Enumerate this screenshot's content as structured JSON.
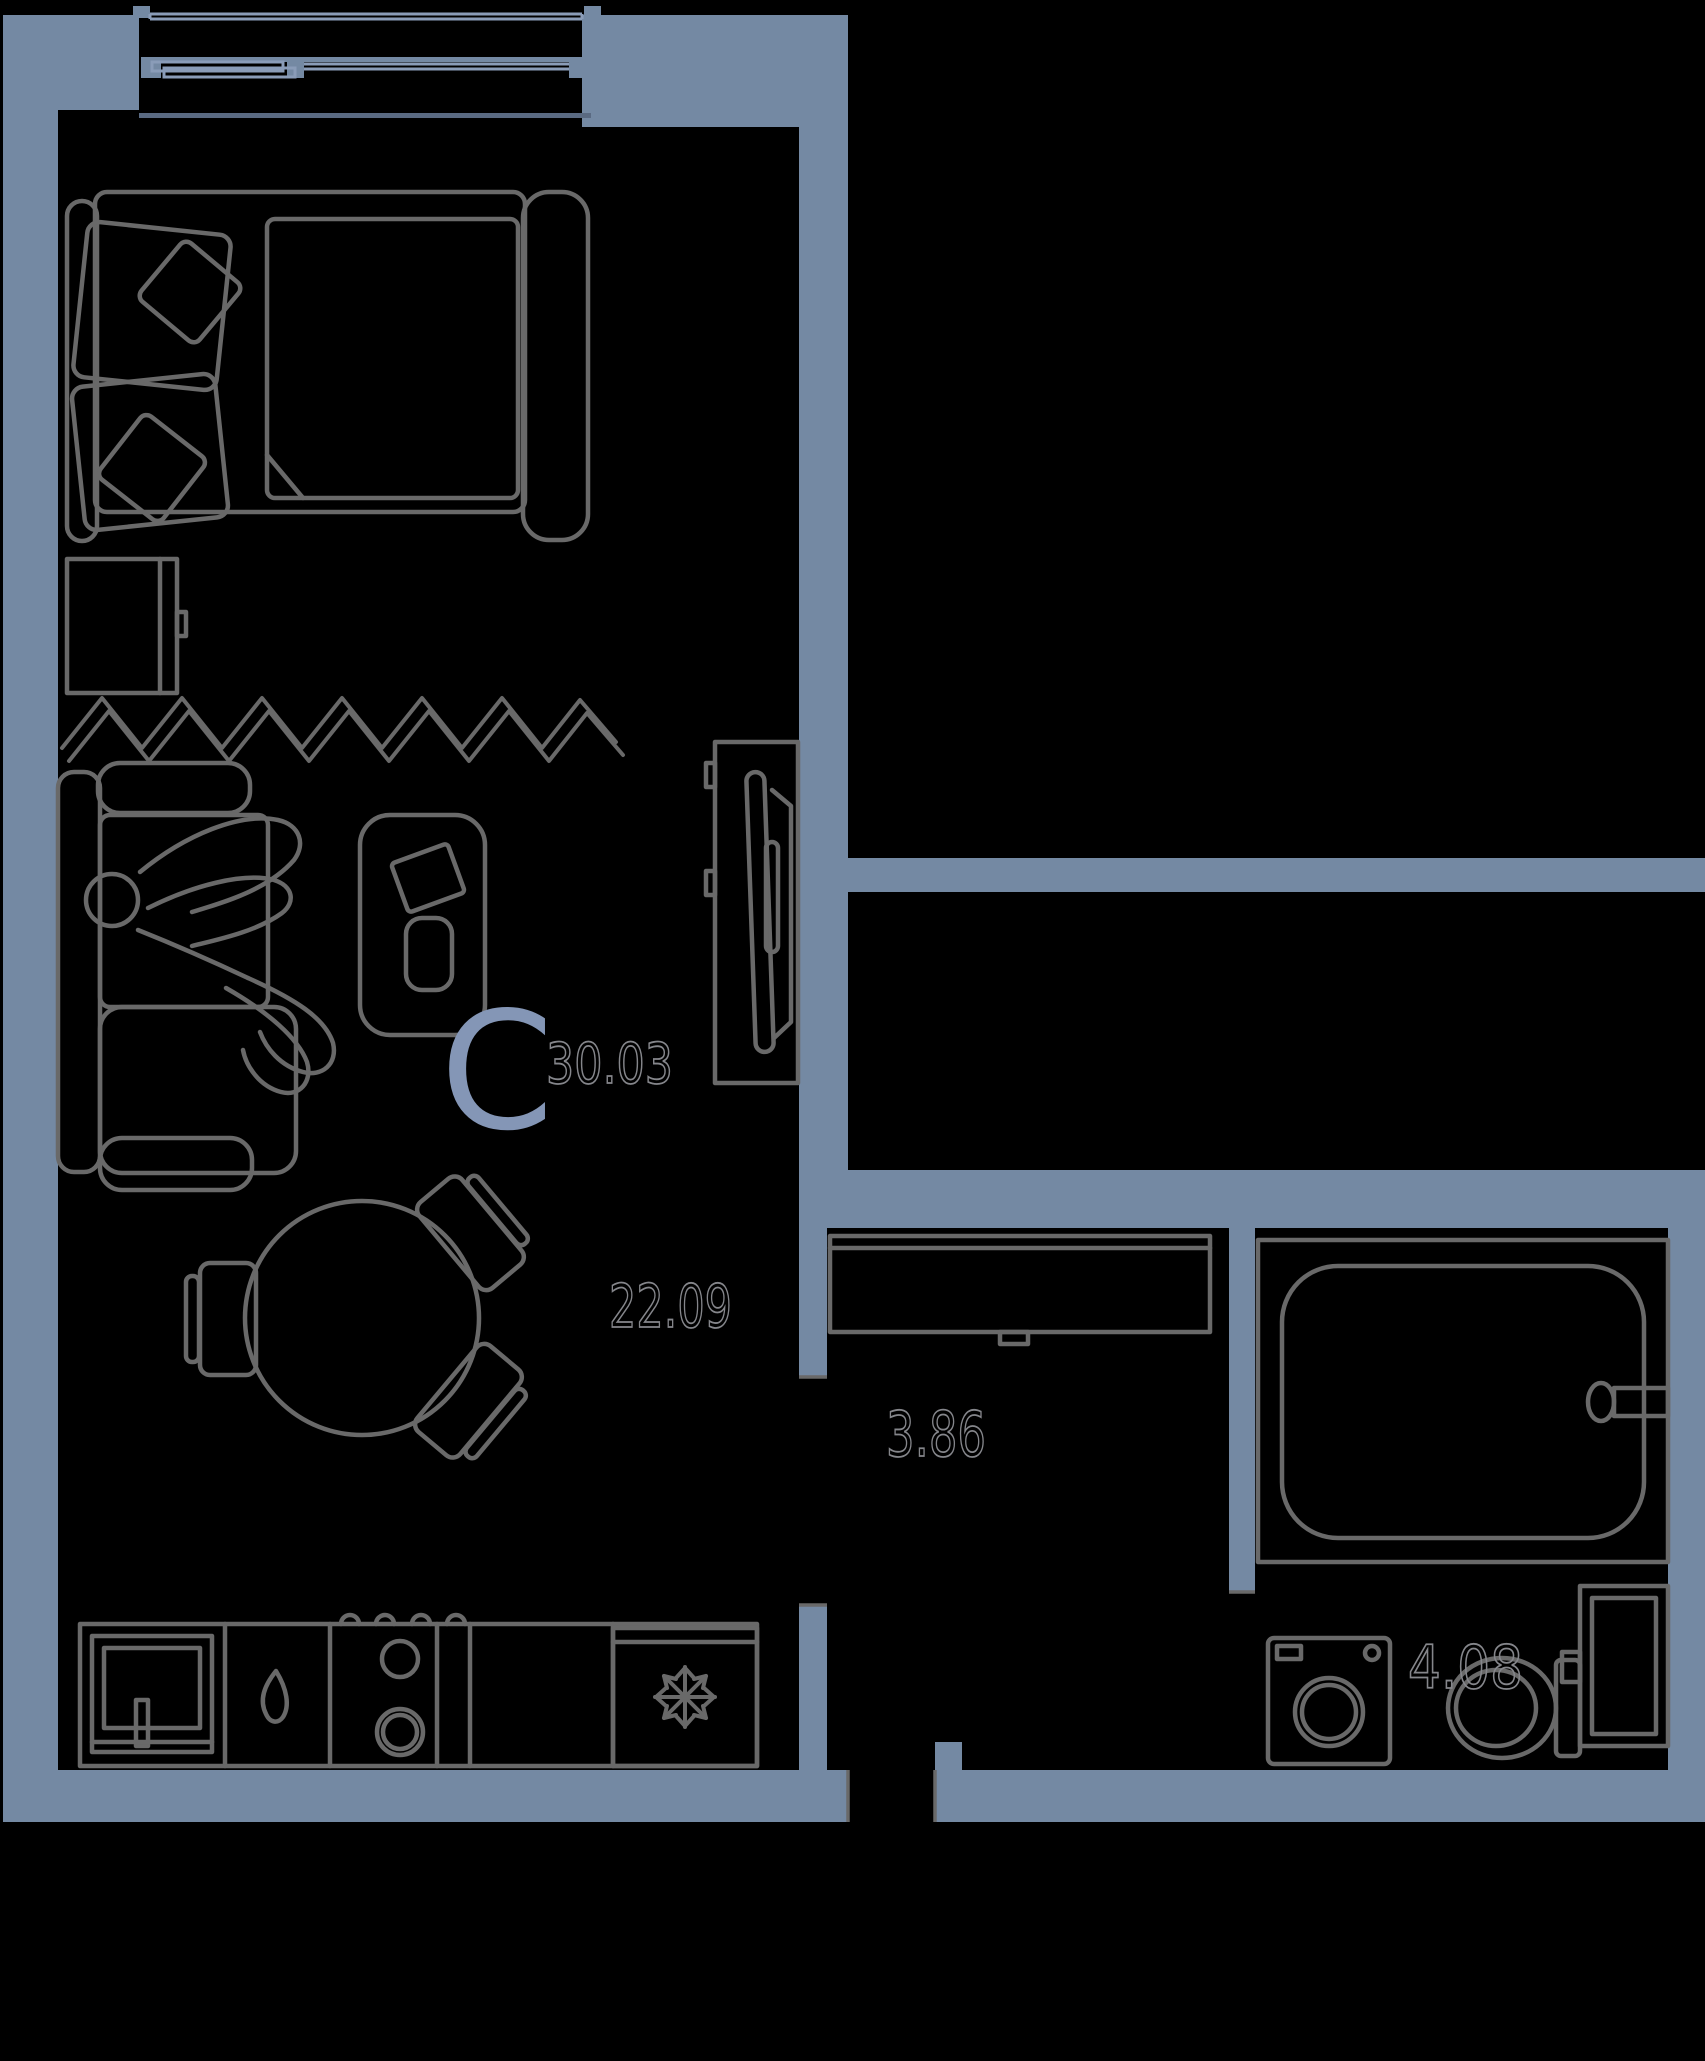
{
  "page": {
    "background": "#000000"
  },
  "floorplan": {
    "unit_type_letter": "С",
    "total_area": "30.03",
    "rooms": [
      {
        "name": "living-room-with-kitchen",
        "area": "22.09"
      },
      {
        "name": "hallway",
        "area": "3.86"
      },
      {
        "name": "bathroom",
        "area": "4.08"
      }
    ],
    "icons": {
      "fridge": "snowflake-icon"
    },
    "colors": {
      "bg": "#000000",
      "wall": "#7489a3",
      "furniture_line": "#696969",
      "glazing": "#8a9cb8",
      "area_label": "#85868b",
      "type_letter": "#8496b6",
      "inner_wall_line": "#5a6a82"
    }
  }
}
